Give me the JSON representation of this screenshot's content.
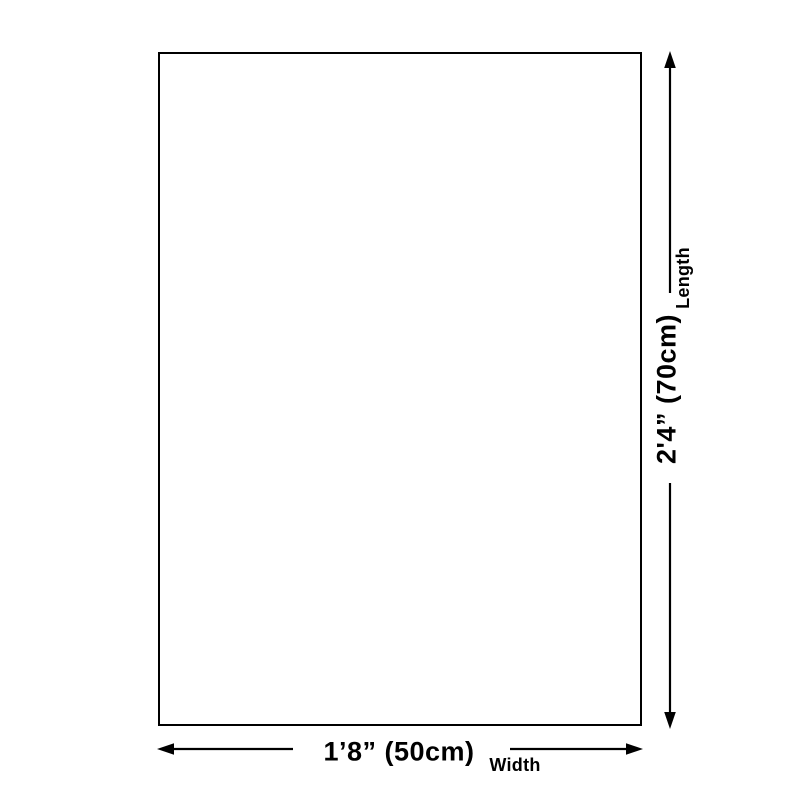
{
  "diagram": {
    "colors": {
      "background": "#ffffff",
      "line": "#000000",
      "text": "#000000",
      "product_fill": "#ffffff"
    },
    "length": {
      "value": "2'4” (70cm)",
      "label": "Length"
    },
    "width": {
      "value": "1’8” (50cm)",
      "label": "Width"
    }
  }
}
